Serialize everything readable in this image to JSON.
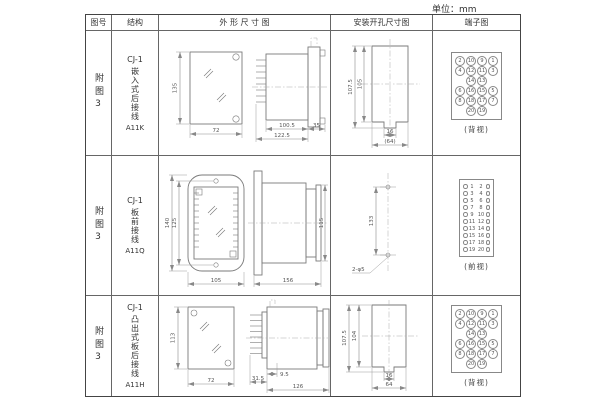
{
  "unit_label": "单位：mm",
  "colors": {
    "line": "#7a7a7a",
    "text": "#444444",
    "background": "#ffffff"
  },
  "header": {
    "figure": "图号",
    "structure": "结构",
    "outline": "外 形 尺 寸 图",
    "mounting": "安装开孔尺寸图",
    "terminal": "端子图"
  },
  "rows": [
    {
      "figure": "附图3",
      "series": "CJ-1",
      "mount_type": "嵌入式后接线",
      "model": "A11K",
      "outline": {
        "front_h": "135",
        "front_w": "72",
        "body_d": "100.5",
        "total_d": "122.5",
        "flange_d": "35"
      },
      "mounting": {
        "outer_h": "107.5",
        "inner_h": "105",
        "slot_w": "16",
        "cutout_w": "(64)"
      },
      "terminal": {
        "view_label": "(背视)",
        "type": "grid",
        "grid": [
          [
            "2",
            "10",
            "9",
            "1"
          ],
          [
            "4",
            "12",
            "11",
            "3"
          ],
          [
            "",
            "14",
            "13",
            ""
          ],
          [
            "6",
            "16",
            "15",
            "5"
          ],
          [
            "8",
            "18",
            "17",
            "7"
          ],
          [
            "",
            "20",
            "19",
            ""
          ]
        ]
      }
    },
    {
      "figure": "附图3",
      "series": "CJ-1",
      "mount_type": "板前接线",
      "model": "A11Q",
      "outline": {
        "outer_h": "140",
        "inner_h": "125",
        "front_w": "105",
        "side_len": "156",
        "side_h": "115"
      },
      "mounting": {
        "hole_pitch": "133",
        "holes": "2-φ5"
      },
      "terminal": {
        "view_label": "(前视)",
        "type": "strip",
        "pairs": [
          [
            "1",
            "2"
          ],
          [
            "3",
            "4"
          ],
          [
            "5",
            "6"
          ],
          [
            "7",
            "8"
          ],
          [
            "9",
            "10"
          ],
          [
            "11",
            "12"
          ],
          [
            "13",
            "14"
          ],
          [
            "15",
            "16"
          ],
          [
            "17",
            "18"
          ],
          [
            "19",
            "20"
          ]
        ]
      }
    },
    {
      "figure": "附图3",
      "series": "CJ-1",
      "mount_type": "凸出式板后接线",
      "model": "A11H",
      "outline": {
        "front_h": "113",
        "front_w": "72",
        "pin_d": "31.5",
        "gap_d": "9.5",
        "body_d": "126"
      },
      "mounting": {
        "outer_h": "107.5",
        "inner_h": "104",
        "slot_w": "16",
        "cutout_w": "64"
      },
      "terminal": {
        "view_label": "(背视)",
        "type": "grid",
        "grid": [
          [
            "2",
            "10",
            "9",
            "1"
          ],
          [
            "4",
            "12",
            "11",
            "3"
          ],
          [
            "",
            "14",
            "13",
            ""
          ],
          [
            "6",
            "16",
            "15",
            "5"
          ],
          [
            "8",
            "18",
            "17",
            "7"
          ],
          [
            "",
            "20",
            "19",
            ""
          ]
        ]
      }
    }
  ]
}
